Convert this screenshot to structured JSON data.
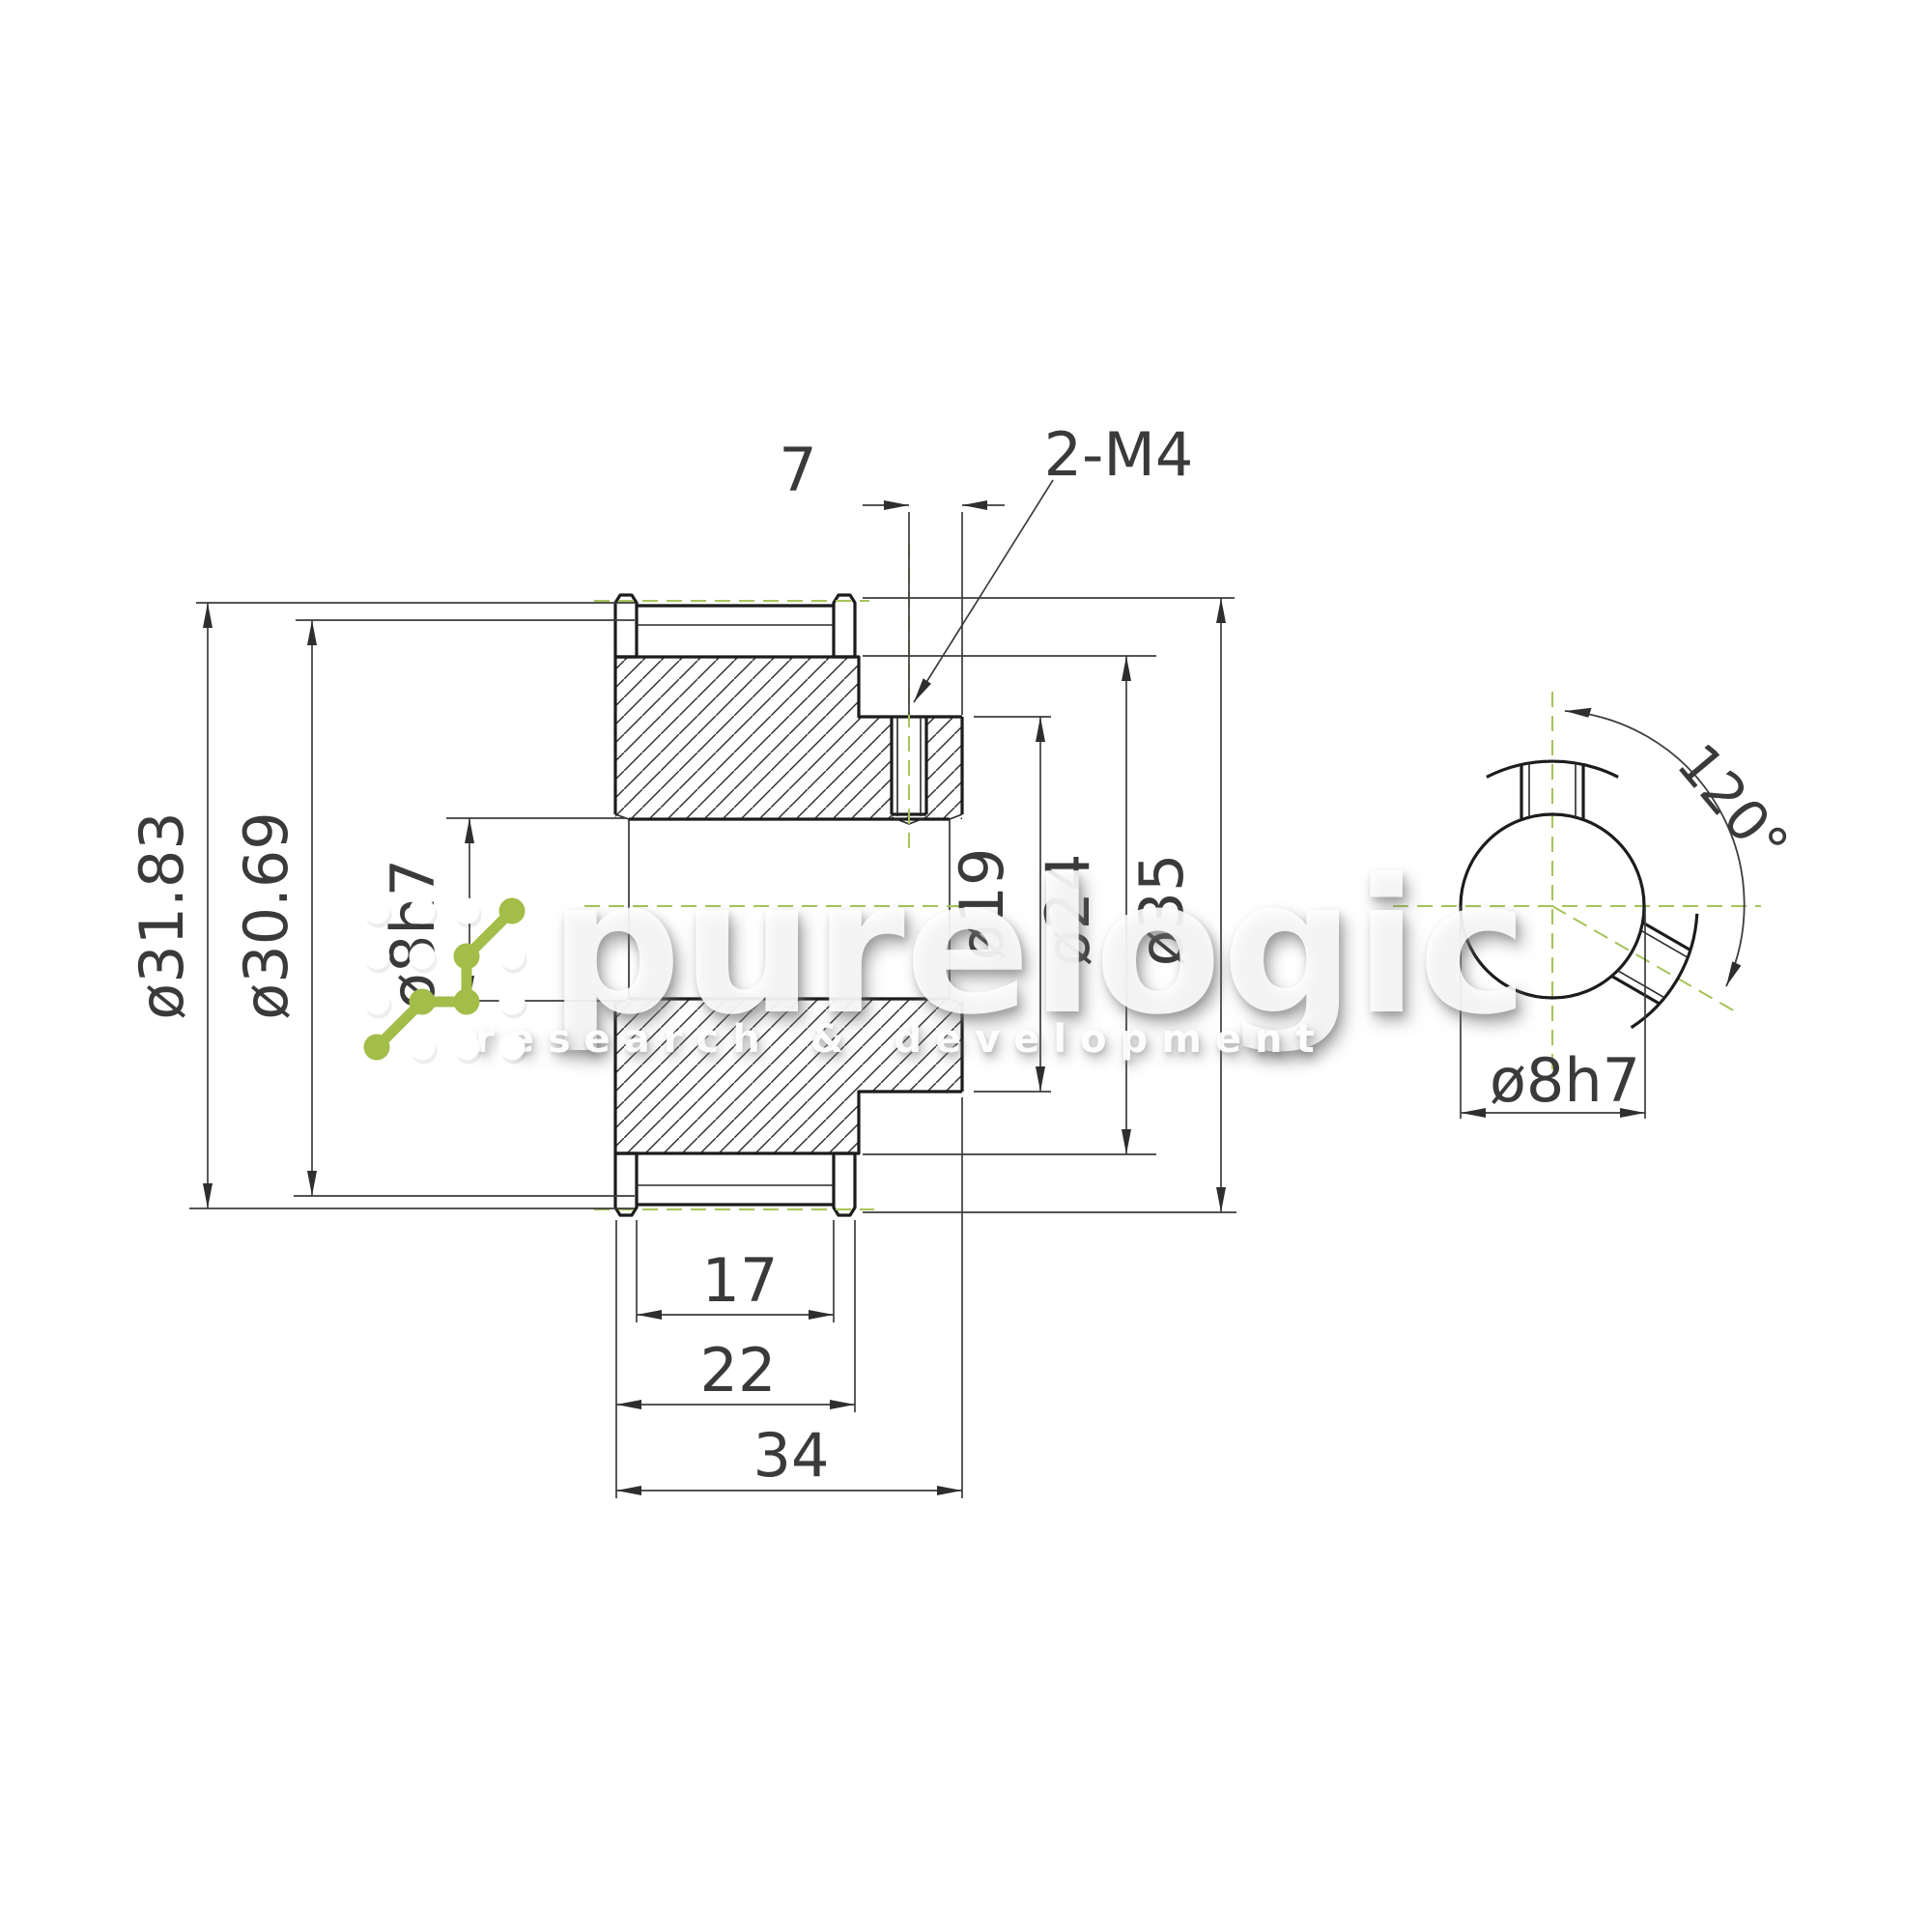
{
  "drawing": {
    "title": "timing pulley technical drawing",
    "labels": {
      "width_top": "7",
      "thread_callout": "2-M4",
      "pitch_diameter": "ø31.83",
      "outer_diameter": "ø30.69",
      "bore_left": "ø8h7",
      "hub_diameter": "ø19",
      "shoulder_diameter": "ø24",
      "flange_diameter": "ø35",
      "belt_width": "17",
      "flange_width": "22",
      "total_width": "34",
      "setscrew_angle": "120°",
      "bore_side": "ø8h7"
    },
    "watermark": {
      "brand": "purelogic",
      "tagline": "research & development"
    },
    "colors": {
      "outline": "#1c1c1c",
      "dimension": "#3d3d3d",
      "centerline_green": "#a6c45a",
      "logo_green": "#a2bd48"
    }
  }
}
